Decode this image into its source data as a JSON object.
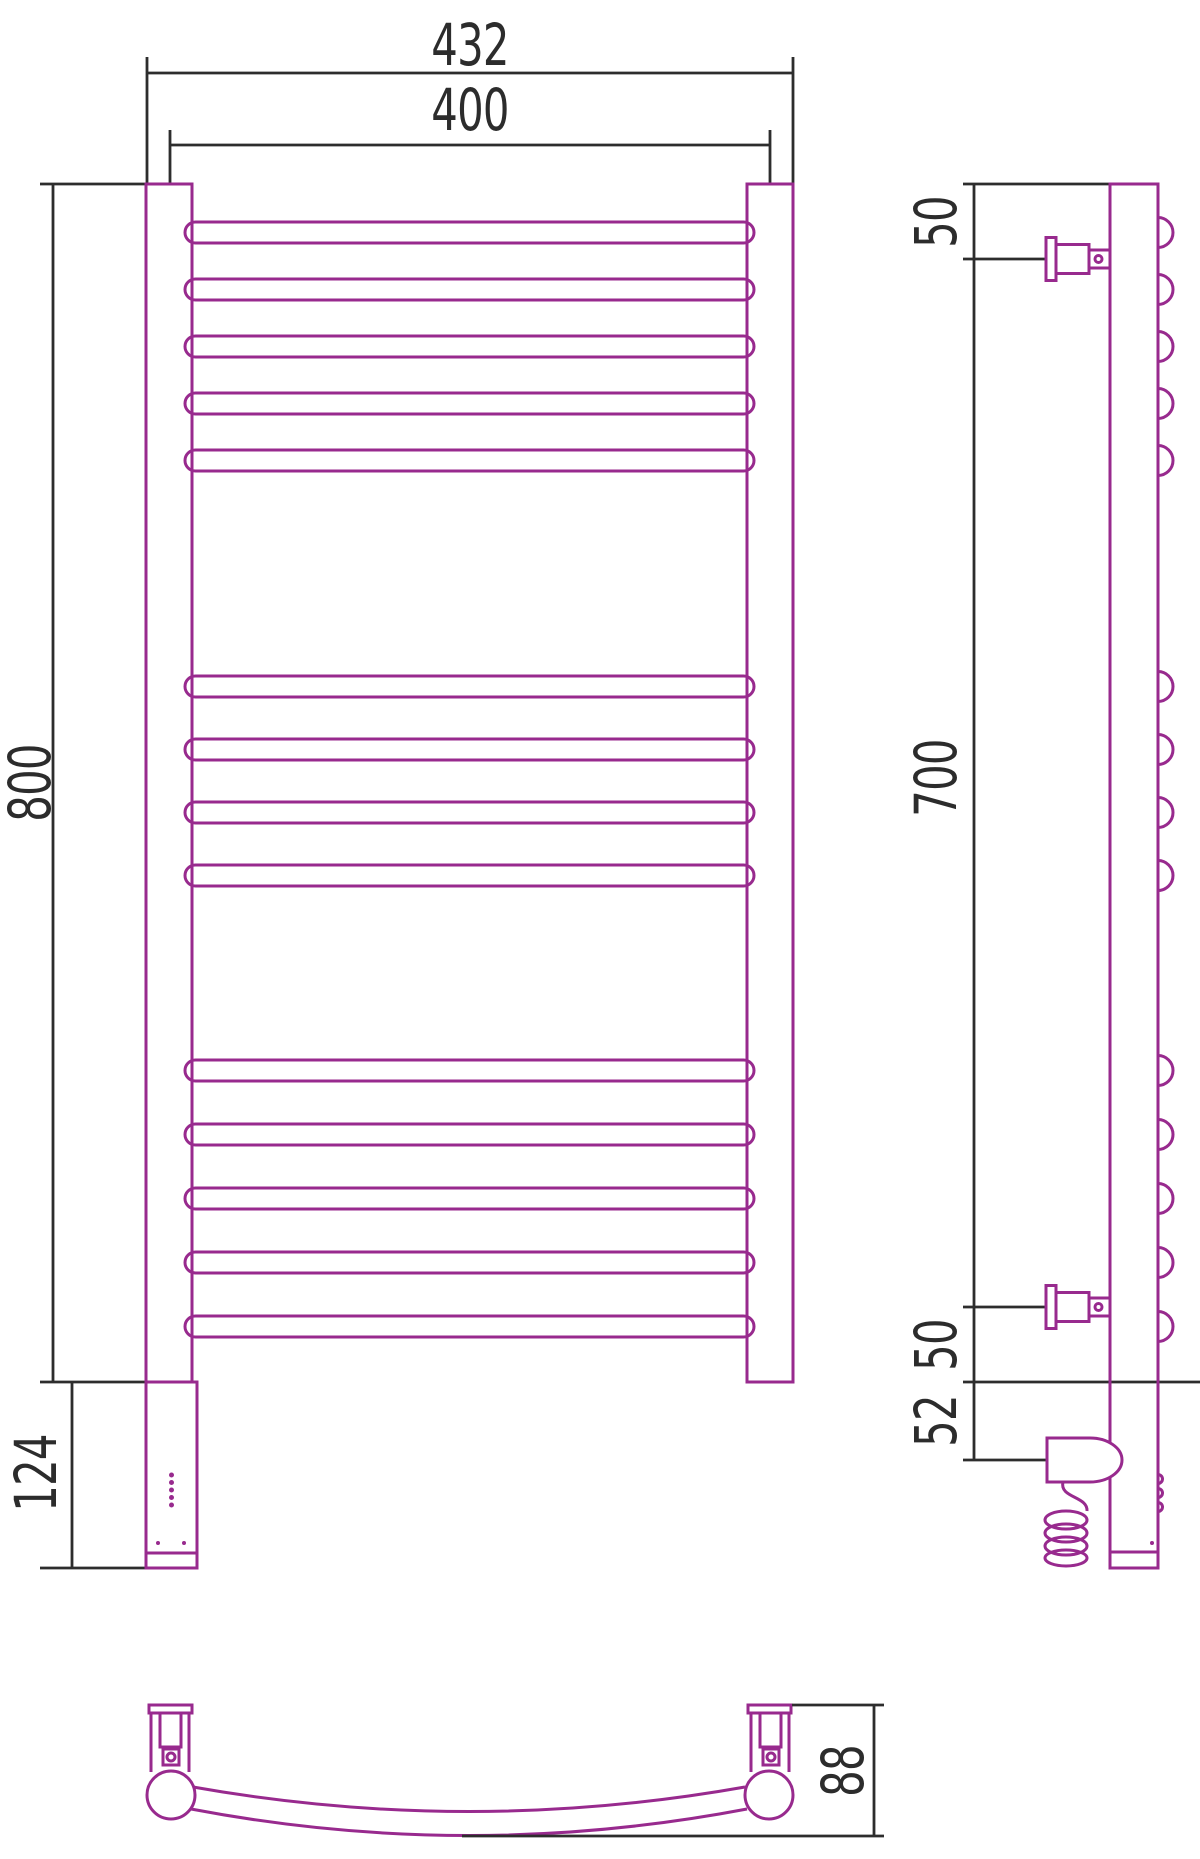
{
  "drawing_title": "heated-towel-rail-technical-drawing",
  "colors": {
    "accent": "#982A8E",
    "line": "#2d2d2d"
  },
  "dimensions": {
    "front": {
      "overall_width": "432",
      "center_width": "400",
      "height": "800",
      "bottom_section": "124"
    },
    "side": {
      "top_bracket_offset": "50",
      "bracket_span": "700",
      "bottom_bracket_offset": "50",
      "heater_offset": "52"
    },
    "bottom": {
      "depth": "88"
    }
  },
  "structure": {
    "rungs": {
      "x": 185,
      "width": 569,
      "height": 21,
      "radius": 10.5,
      "groups": [
        {
          "count": 5,
          "top": 222,
          "spacing": 57
        },
        {
          "count": 4,
          "top": 676,
          "spacing": 63
        },
        {
          "count": 5,
          "top": 1060,
          "spacing": 64
        }
      ]
    },
    "side_rung_ends": {
      "x": 1158,
      "radius": 15
    },
    "side_led_bumps": {
      "x": 1158,
      "radius": 4.5,
      "centers": [
        1479,
        1493,
        1507
      ]
    },
    "front_leds": {
      "cx": 171.5,
      "radius": 2.5,
      "start": 1475,
      "step": 7.5,
      "count": 5
    },
    "front_screws": {
      "radius": 2,
      "cy": 1543,
      "cx_list": [
        158,
        184
      ]
    }
  }
}
